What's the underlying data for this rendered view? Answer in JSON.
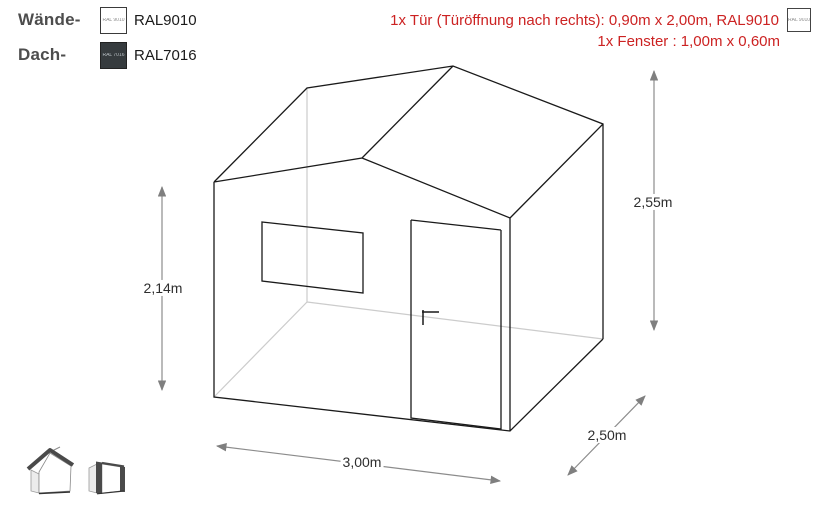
{
  "legend": {
    "rows": [
      {
        "label": "Wände-",
        "ral_code": "RAL9010",
        "swatch_text": "RAL 9010",
        "swatch_color": "#ffffff",
        "swatch_text_color": "#8a8a8a"
      },
      {
        "label": "Dach-",
        "ral_code": "RAL7016",
        "swatch_text": "RAL 7016",
        "swatch_color": "#363b3e",
        "swatch_text_color": "#b8bfc3"
      }
    ]
  },
  "annotations": {
    "text_color": "#cc2222",
    "door": {
      "text": "1x Tür (Türöffnung nach rechts): 0,90m x 2,00m, RAL9010",
      "swatch_text": "RAL 9010",
      "swatch_color": "#ffffff"
    },
    "window": {
      "text": "1x Fenster : 1,00m x 0,60m"
    }
  },
  "dimensions": {
    "wall_height": "2,14m",
    "ridge_height": "2,55m",
    "front_width": "3,00m",
    "side_depth": "2,50m"
  },
  "drawing": {
    "line_color": "#1a1a1a",
    "hidden_line_color": "#cccccc",
    "dimension_color": "#808080"
  },
  "icons": {
    "gable_view": "gable-roof-shed-thumbnail",
    "pent_view": "pent-roof-shed-thumbnail"
  }
}
